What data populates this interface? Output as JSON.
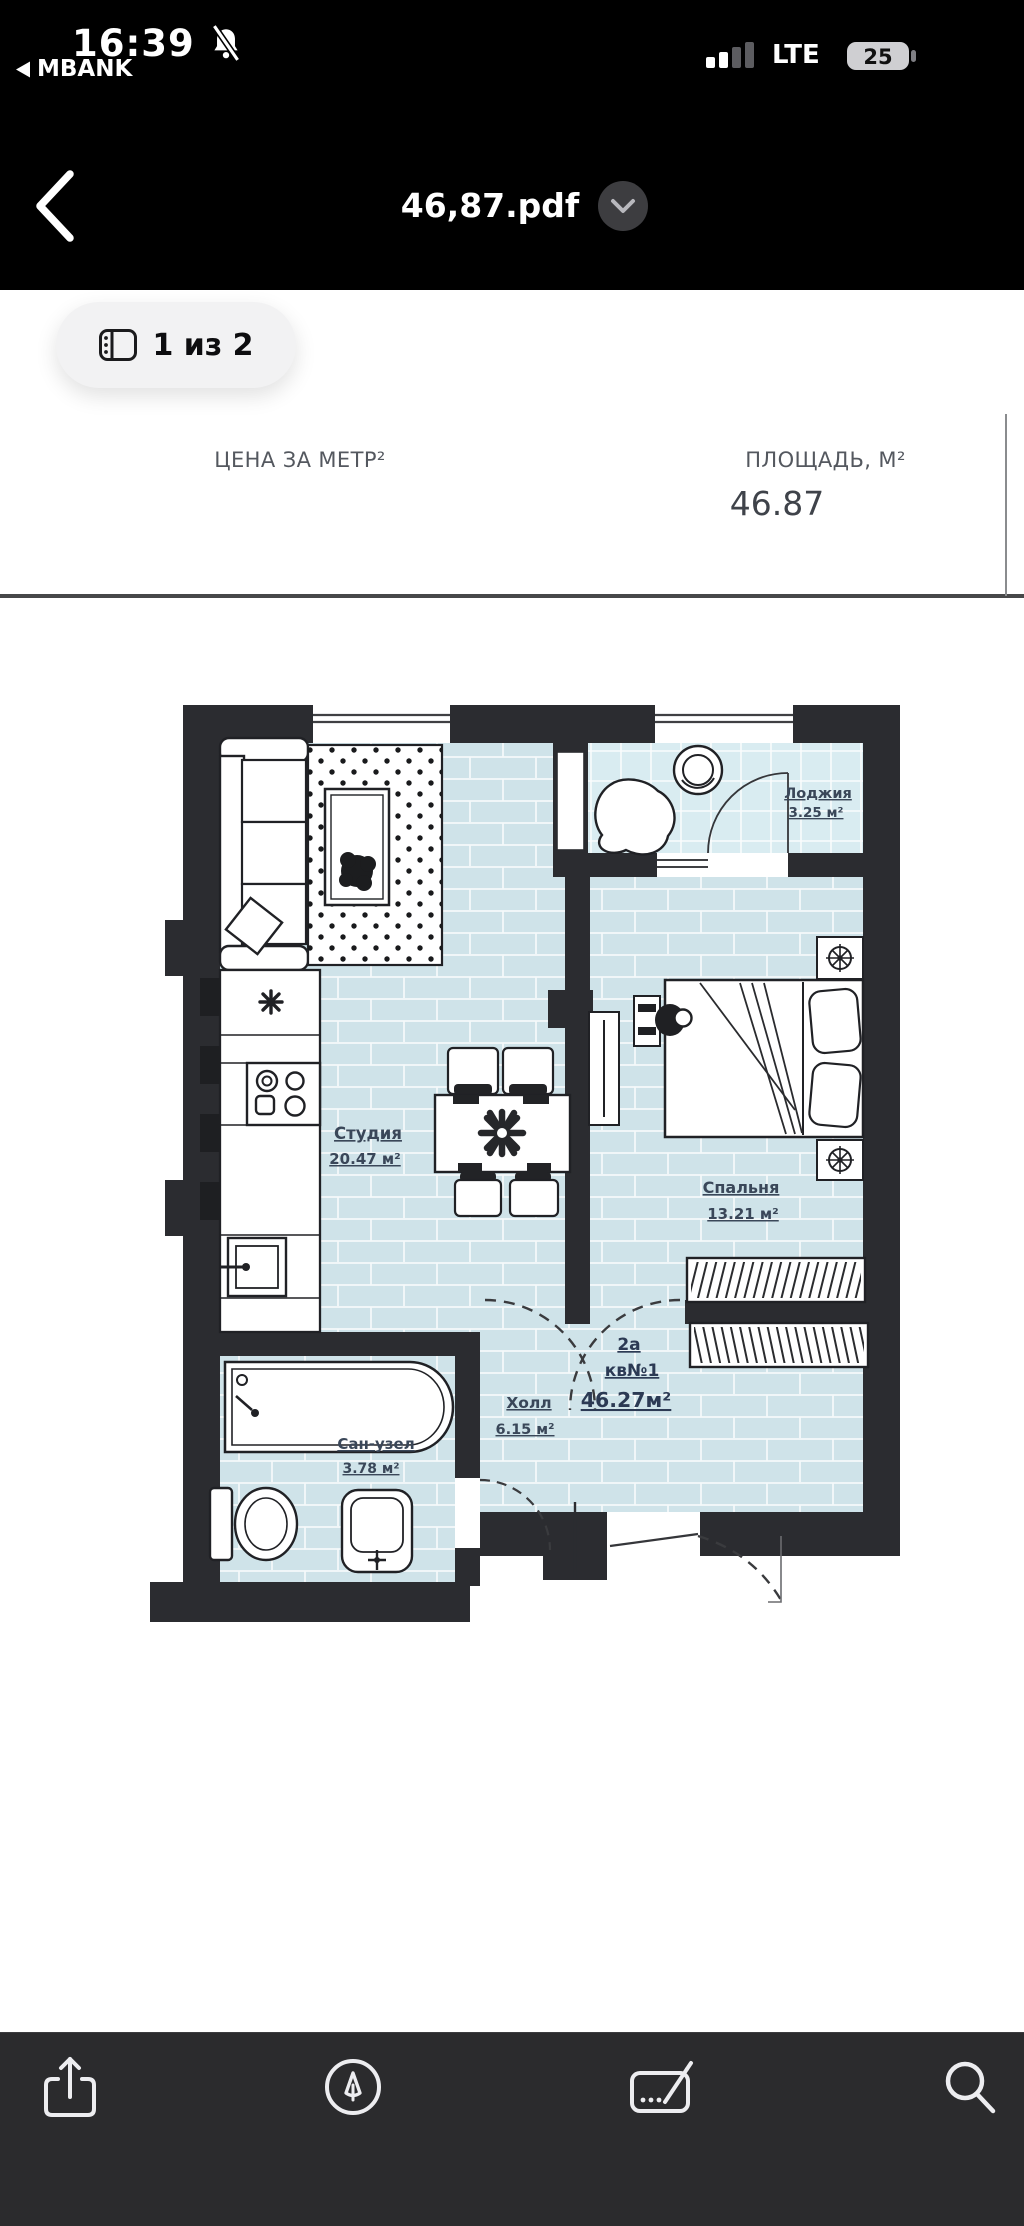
{
  "status_bar": {
    "time": "16:39",
    "return_app": "MBANK",
    "network": "LTE",
    "battery_level": "25",
    "icons": {
      "notifications": "bell-slash-icon",
      "signal": "cellular-bars-icon",
      "battery": "battery-icon"
    }
  },
  "nav_bar": {
    "title": "46,87.pdf",
    "icons": {
      "back": "chevron-left-icon",
      "title_menu": "chevron-down-icon"
    }
  },
  "content": {
    "page_indicator": "1 из 2",
    "table": {
      "price_header": "ЦЕНА ЗА МЕТР²",
      "area_header": "ПЛОЩАДЬ, М²",
      "area_value": "46.87"
    }
  },
  "floor_plan": {
    "rooms": [
      {
        "name": "Лоджия",
        "area": "3.25 м²"
      },
      {
        "name": "Студия",
        "area": "20.47 м²"
      },
      {
        "name": "Спальня",
        "area": "13.21 м²"
      },
      {
        "name": "Холл",
        "area": "6.15 м²"
      },
      {
        "name": "Сан-узел",
        "area": "3.78 м²"
      }
    ],
    "apartment": {
      "block": "2а",
      "unit": "кв№1",
      "total_area": "46.27м²"
    }
  },
  "toolbar": {
    "buttons": [
      "share-icon",
      "markup-icon",
      "signature-icon",
      "search-icon"
    ]
  },
  "colors": {
    "floor": "#cfe3e9",
    "loggia_floor": "#d9ecf1",
    "walls": "#2b2c30",
    "label": "#3a4759",
    "toolbar_bg": "#2b2b2d"
  }
}
